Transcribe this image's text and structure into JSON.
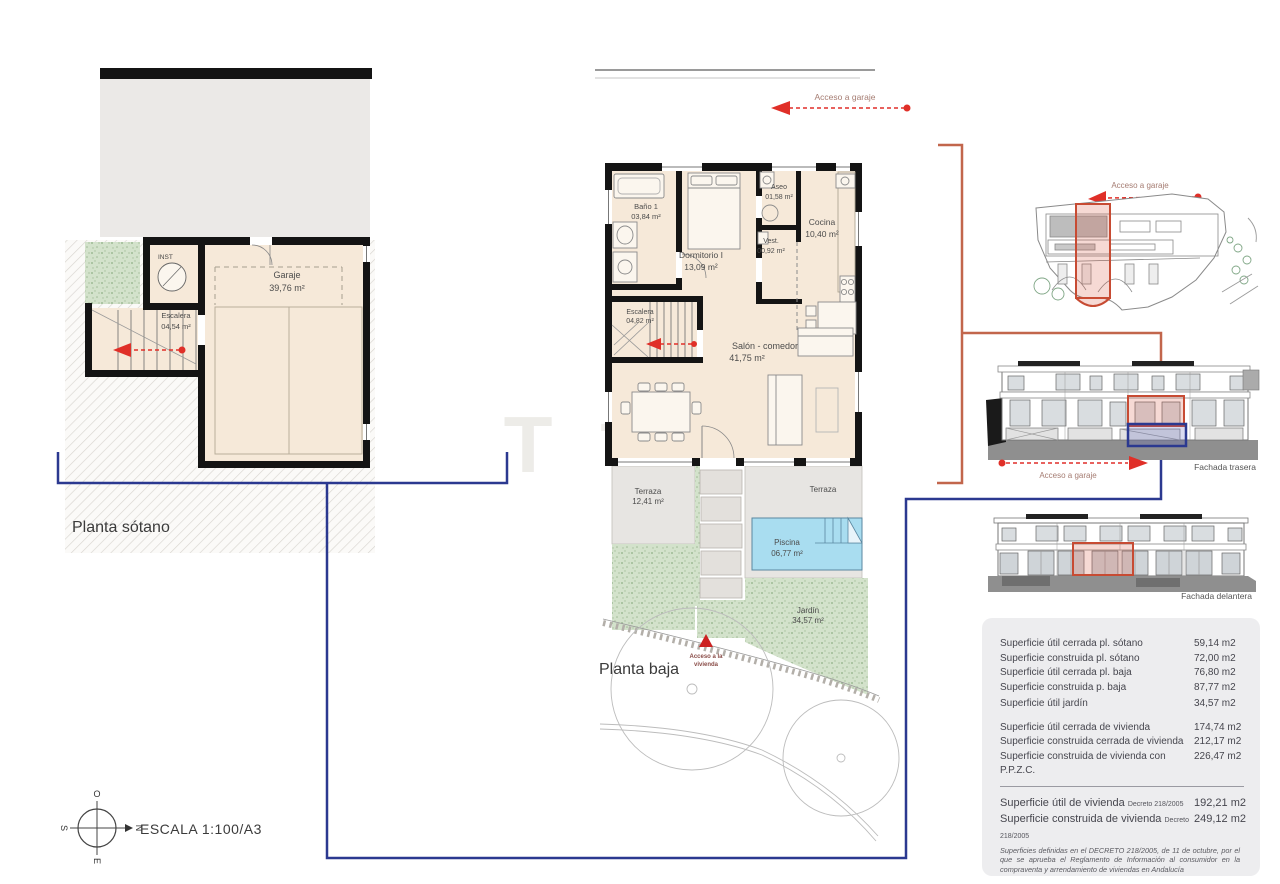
{
  "plan_titles": {
    "sotano": "Planta sótano",
    "baja": "Planta baja"
  },
  "scale_label": "ESCALA 1:100/A3",
  "compass": {
    "top": "O",
    "right": "N",
    "bottom": "E",
    "left": "S"
  },
  "annotations": {
    "acceso_garaje_top": "Acceso a garaje",
    "acceso_garaje_site": "Acceso a garaje",
    "acceso_garaje_rear": "Acceso a garaje",
    "acceso_vivienda_line1": "Acceso a la",
    "acceso_vivienda_line2": "vivienda"
  },
  "basement_rooms": {
    "inst": {
      "name": "INST"
    },
    "garaje": {
      "name": "Garaje",
      "area": "39,76 m²"
    },
    "escalera": {
      "name": "Escalera",
      "area": "04,54 m²"
    }
  },
  "ground_rooms": {
    "bano": {
      "name": "Baño 1",
      "area": "03,84 m²"
    },
    "dormitorio": {
      "name": "Dormitorio I",
      "area": "13,09 m²"
    },
    "aseo": {
      "name": "Aseo",
      "area": "01,58 m²"
    },
    "vest": {
      "name": "Vest.",
      "area": "00,92 m²"
    },
    "cocina": {
      "name": "Cocina",
      "area": "10,40 m²"
    },
    "escalera": {
      "name": "Escalera",
      "area": "04,82 m²"
    },
    "salon": {
      "name": "Salón - comedor",
      "area": "41,75 m²"
    },
    "terraza_izq": {
      "name": "Terraza",
      "area": "12,41 m²"
    },
    "terraza_der": {
      "name": "Terraza"
    },
    "piscina": {
      "name": "Piscina",
      "area": "06,77 m²"
    },
    "jardin": {
      "name": "Jardín",
      "area": "34,57 m²"
    }
  },
  "elevations": {
    "rear_label": "Fachada trasera",
    "front_label": "Fachada delantera"
  },
  "surface_table": {
    "rows": [
      {
        "label": "Superficie útil cerrada pl. sótano",
        "value": "59,14 m2"
      },
      {
        "label": "Superficie construida pl. sótano",
        "value": "72,00 m2"
      },
      {
        "label": "Superficie útil cerrada pl. baja",
        "value": "76,80 m2"
      },
      {
        "label": "Superficie construida p. baja",
        "value": "87,77 m2"
      },
      {
        "label": "Superficie útil jardín",
        "value": "34,57 m2"
      },
      {
        "label": "Superficie útil cerrada de vivienda",
        "value": "174,74 m2"
      },
      {
        "label": "Superficie construida cerrada de vivienda",
        "value": "212,17 m2"
      },
      {
        "label": "Superficie construida de vivienda con P.P.Z.C.",
        "value": "226,47 m2"
      }
    ],
    "decreto_rows": [
      {
        "label": "Superficie útil de vivienda",
        "suffix": "Decreto 218/2005",
        "value": "192,21 m2"
      },
      {
        "label": "Superficie construida de vivienda",
        "suffix": "Decreto 218/2005",
        "value": "249,12 m2"
      }
    ],
    "footnote": "Superficies definidas en el DECRETO 218/2005, de 11 de octubre, por el que se aprueba el Reglamento de Información al consumidor en la compraventa y arrendamiento de viviendas en Andalucía"
  },
  "watermark": "T",
  "colors": {
    "navy": "#2b3990",
    "terracotta": "#c2664c",
    "arrow_red": "#e02f28",
    "highlight_red": "#c74b33",
    "room_fill": "#f6e9d9",
    "terrace_gray": "#e7e5e2",
    "garden_green": "#cfe0c6",
    "pool_blue": "#a9ddf0"
  }
}
